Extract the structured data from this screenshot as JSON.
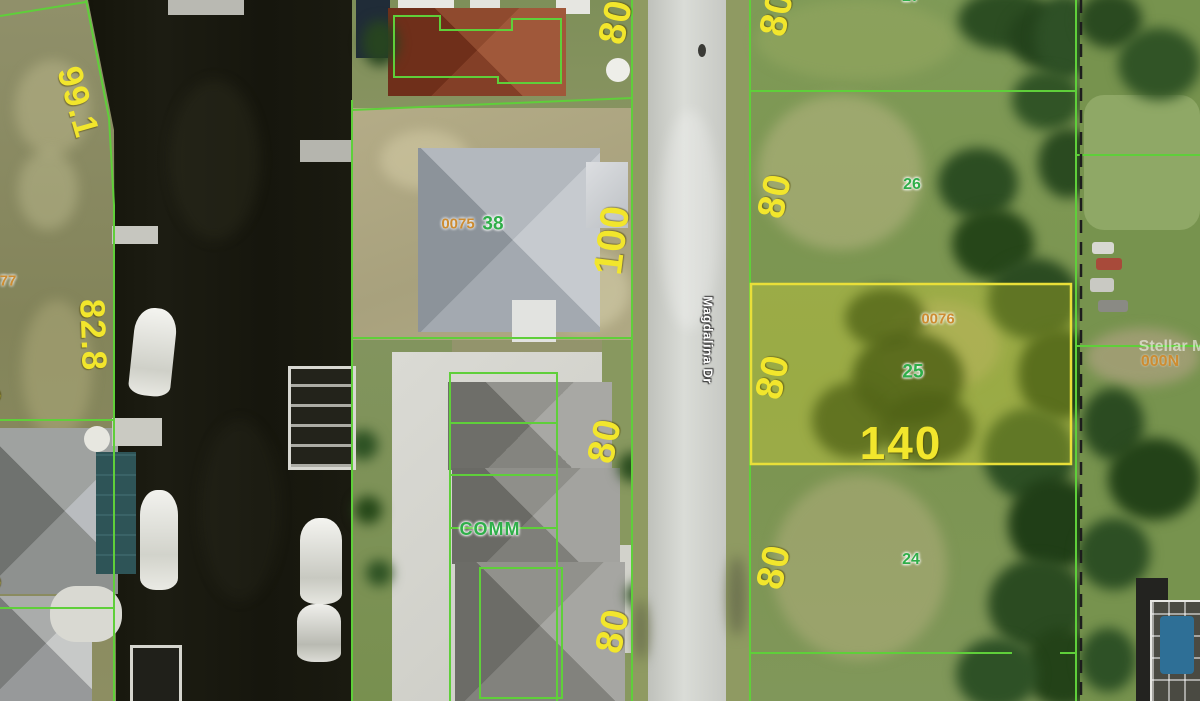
{
  "map_type": "aerial-parcel-overlay",
  "road": {
    "name": "Magdalina Dr"
  },
  "watermark": {
    "text": "Stellar M"
  },
  "labels": {
    "dimensions": {
      "canal_nw": "99.1",
      "canal_w": "82.8",
      "front_100": "100",
      "front_80": "80",
      "depth_140": "140",
      "partial_digit": "0"
    },
    "lot_numbers": {
      "lot27": "27",
      "lot26": "26",
      "lot25": "25",
      "lot24": "24",
      "lot38": "38"
    },
    "parcel_ids": {
      "subject": "0076",
      "house": "0075",
      "partial_west": "77"
    },
    "zoning_comm": "COMM",
    "address_000n": "000N"
  },
  "subject_parcel": {
    "id": "0076",
    "lot_number": "25",
    "frontage_ft": "80",
    "depth_ft": "140"
  },
  "colors": {
    "boundary_green": "#5fcf3a",
    "dimension_yellow": "#f2e62c",
    "lot_number_green": "#2fae49",
    "parcel_id_orange": "#cd8c31",
    "subject_fill_yellow": "#f0e83a",
    "subject_stroke_yellow": "#e9df39",
    "section_dash_black": "#1d1d1d",
    "road_label_white": "#ffffff"
  }
}
